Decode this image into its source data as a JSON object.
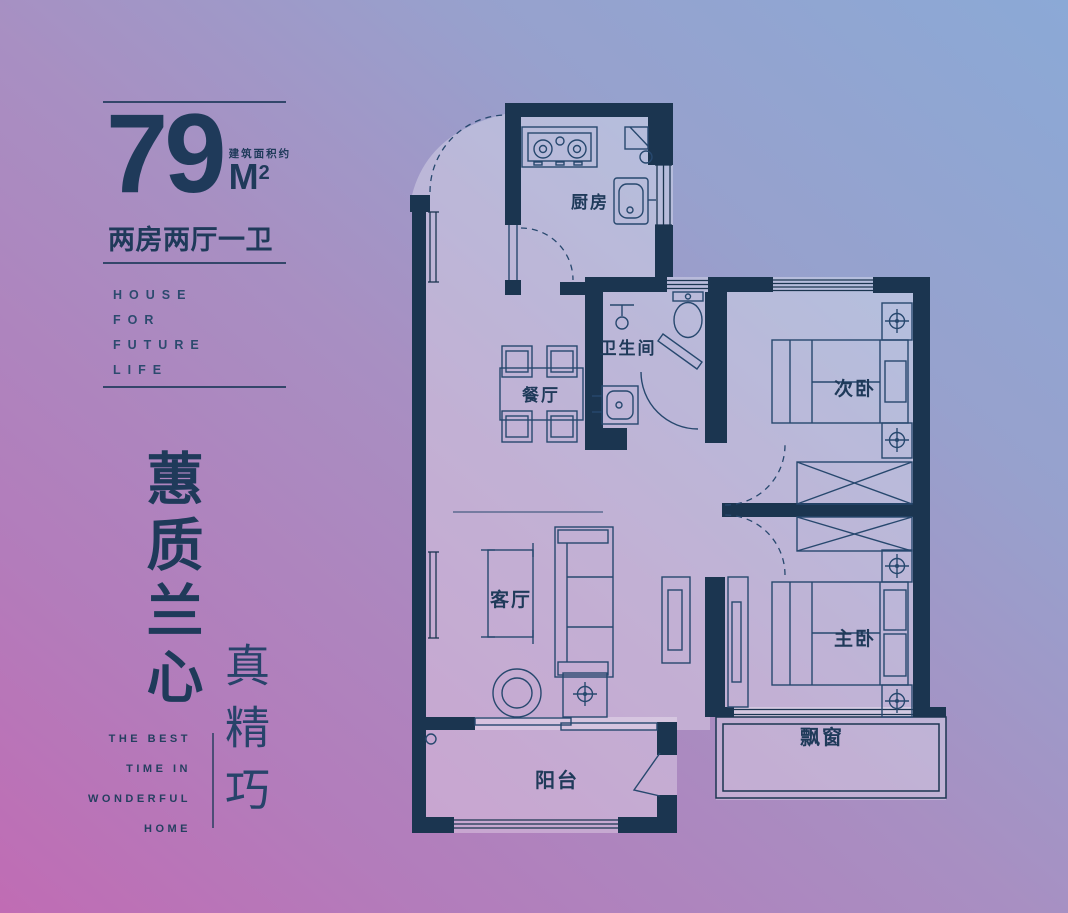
{
  "palette": {
    "ink": "#1f3a5a",
    "wall": "#1b3550",
    "line": "#27486e",
    "gradient_bottom_left": "#bf6fb5",
    "gradient_middle": "#a88fc2",
    "gradient_top_right": "#8ba9d6"
  },
  "info_panel": {
    "area_value": "79",
    "area_unit": "M",
    "area_unit_sup": "2",
    "area_note": "建筑面积约",
    "layout_summary": "两房两厅一卫",
    "slogan_en": [
      "HOUSE",
      "FOR",
      "FUTURE",
      "LIFE"
    ],
    "slogan_cn_primary": "蕙质兰心",
    "slogan_cn_secondary": "真精巧",
    "tagline_en": [
      "THE BEST",
      "TIME IN",
      "WONDERFUL",
      "HOME"
    ]
  },
  "floor_plan": {
    "rooms": {
      "kitchen": "厨房",
      "dining": "餐厅",
      "bathroom": "卫生间",
      "second_bedroom": "次卧",
      "living_room": "客厅",
      "master_bedroom": "主卧",
      "bay_window": "飘窗",
      "balcony": "阳台"
    }
  }
}
